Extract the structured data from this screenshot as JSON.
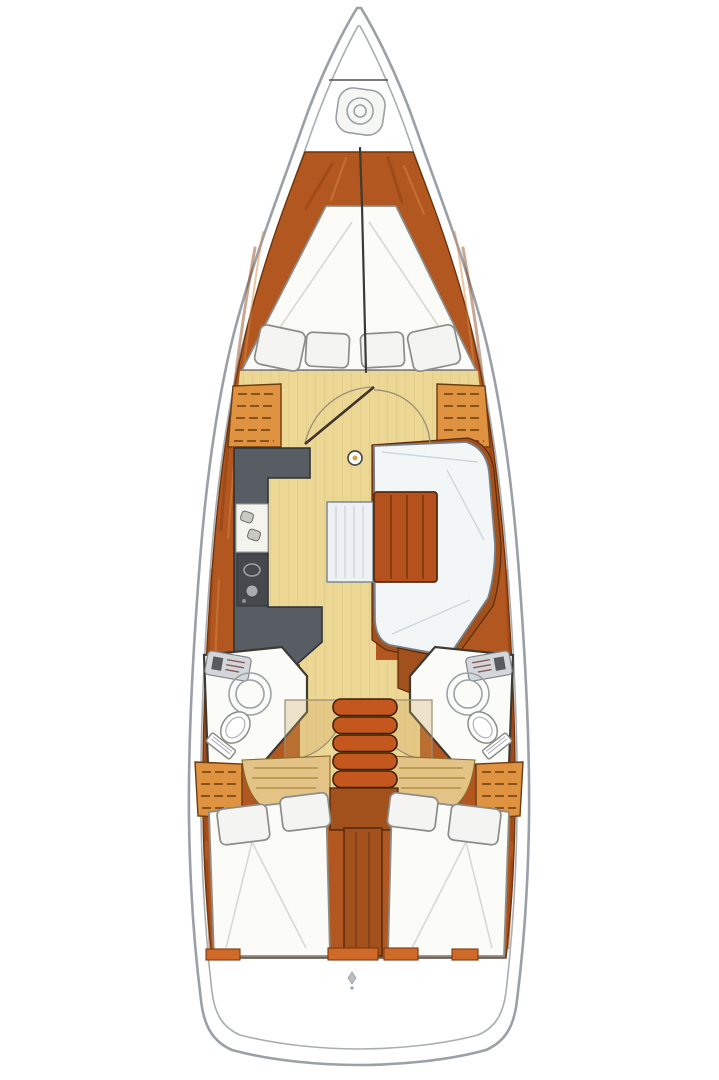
{
  "diagram": {
    "type": "yacht-interior-floor-plan",
    "orientation": "bow-at-top",
    "rooms": [
      {
        "id": "anchor-locker",
        "label": "anchor locker"
      },
      {
        "id": "forward-cabin",
        "label": "forward cabin with V-berth and 4 pillows"
      },
      {
        "id": "salon",
        "label": "salon with U-settee, wood table and bench seat"
      },
      {
        "id": "galley",
        "label": "L-shaped galley with sink and stove"
      },
      {
        "id": "port-head",
        "label": "port head with shower, sink and toilet"
      },
      {
        "id": "starboard-head",
        "label": "starboard head with shower, sink and toilet"
      },
      {
        "id": "companionway",
        "label": "companionway steps over engine compartment"
      },
      {
        "id": "port-aft-cabin",
        "label": "port aft cabin double berth with 2 pillows"
      },
      {
        "id": "starboard-aft-cabin",
        "label": "starboard aft cabin double berth with 2 pillows"
      },
      {
        "id": "lazarette",
        "label": "stern lazarette"
      }
    ],
    "icons": [
      "bow-hatch-icon",
      "mast-post-icon",
      "stern-fitting-icon",
      "door-swing-arcs",
      "shelf-locker-hatching"
    ]
  },
  "palette": {
    "hull_line": "#9aa0a6",
    "deck": "#b2571f",
    "deck_stroke": "#6e3409",
    "streak_dark": "#8a3c10",
    "streak_light": "#d98c4a",
    "wall": "#3d3a34",
    "floor": "#ecd795",
    "white_room": "#fbfbf8",
    "room_stroke": "#8c8c88",
    "galley": "#585d63",
    "galley_dark": "#45494e",
    "sink_white": "#f4f4ef",
    "settee": "#f3f6f7",
    "settee_line": "#ccd7de",
    "settee_stroke": "#76838f",
    "table": "#b4511c",
    "table_stroke": "#5a2a0b",
    "bench": "#edf1f3",
    "locker": "#df923f",
    "locker_line": "#6b3c12",
    "steps": "#c4571e",
    "engine": "#a2511c",
    "arc": "#9a8f76",
    "fixture": "#9aa2a8",
    "tan_bench": "#e3c386",
    "orange_block": "#cf6a28"
  }
}
